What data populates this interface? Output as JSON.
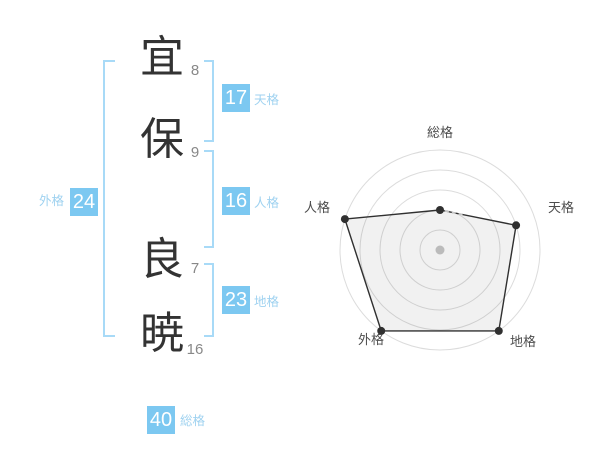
{
  "name_panel": {
    "chars": [
      {
        "char": "宜",
        "strokes": "8"
      },
      {
        "char": "保",
        "strokes": "9"
      },
      {
        "char": "良",
        "strokes": "7"
      },
      {
        "char": "暁",
        "strokes": "16"
      }
    ],
    "scores": {
      "tenkaku": {
        "value": "17",
        "label": "天格"
      },
      "jinkaku": {
        "value": "16",
        "label": "人格"
      },
      "chikaku": {
        "value": "23",
        "label": "地格"
      },
      "gaikaku": {
        "value": "24",
        "label": "外格"
      },
      "soukaku": {
        "value": "40",
        "label": "総格"
      }
    },
    "colors": {
      "score_box": "#7cc8f1",
      "bracket": "#a8daf7",
      "score_label_text": "#9fd2f0"
    }
  },
  "chart_data": {
    "type": "radar",
    "axes": [
      "総格",
      "天格",
      "地格",
      "外格",
      "人格"
    ],
    "values": [
      40,
      80,
      100,
      100,
      100
    ],
    "max": 100,
    "rings": 5,
    "grid": "circular",
    "legend": "none",
    "colors": {
      "ring": "#dcdcdc",
      "polygon_stroke": "#303030",
      "polygon_fill": "rgba(0,0,0,0.055)",
      "center_dot": "#c6c6c6"
    }
  }
}
